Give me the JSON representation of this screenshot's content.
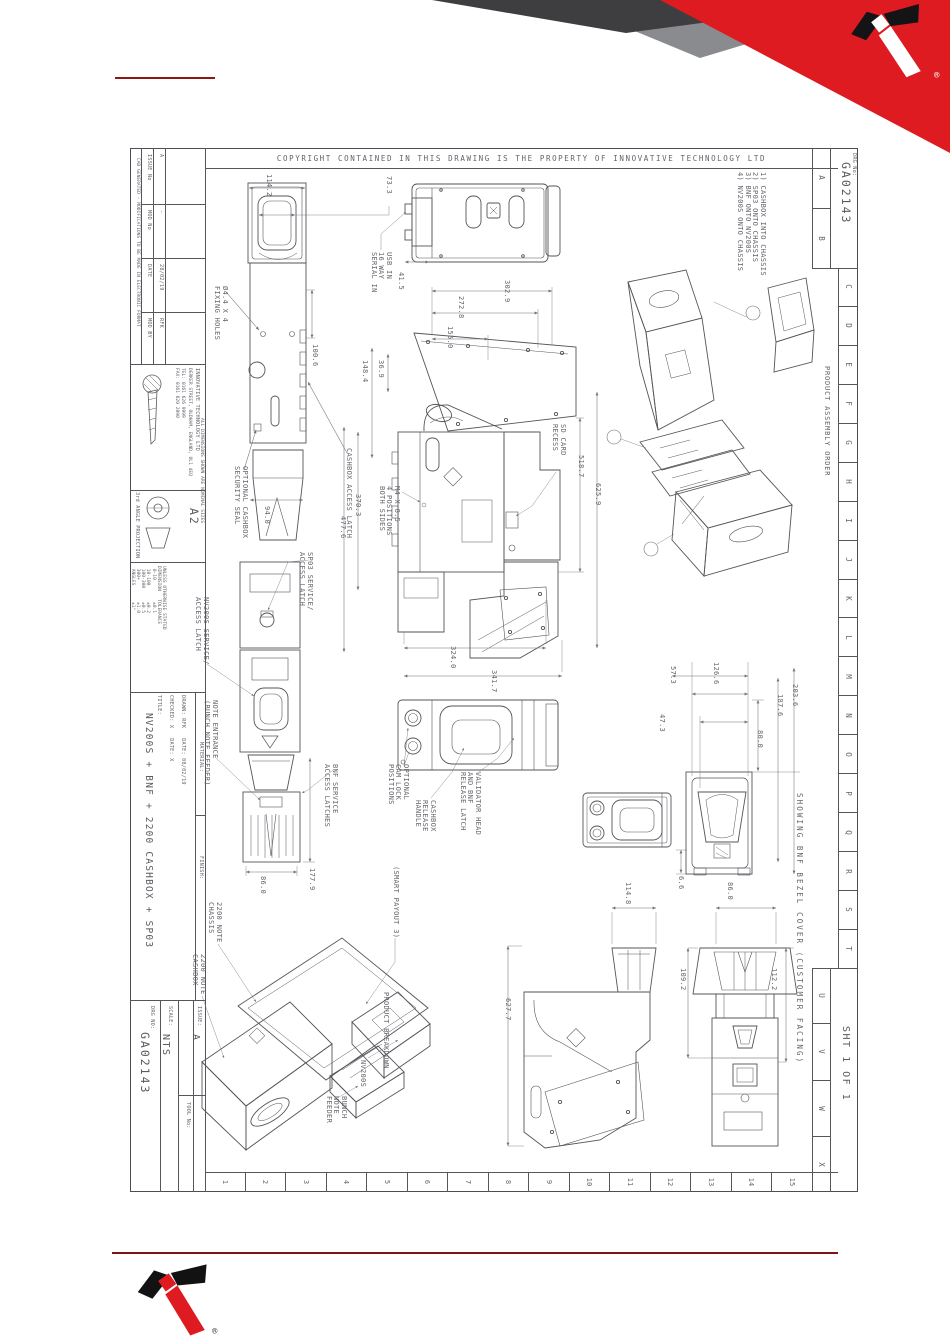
{
  "colors": {
    "accent_red": "#dd1b21",
    "dark_red_rule": "#7a1416",
    "corner_dark": "#3e3e41",
    "corner_mid": "#8a8b8e",
    "line_gray": "#55555a",
    "text_gray": "#64646b"
  },
  "header": {
    "copyright": "COPYRIGHT CONTAINED IN THIS DRAWING IS THE PROPERTY OF INNOVATIVE TECHNOLOGY LTD"
  },
  "drg_box": {
    "label": "DRG No:",
    "number": "GA02143"
  },
  "sheet_box": {
    "text": "SHT 1 OF 1"
  },
  "grid": {
    "letters_top": [
      "A",
      "B"
    ],
    "letters_side": [
      "C",
      "D",
      "E",
      "F",
      "G",
      "H",
      "I",
      "J",
      "K",
      "L",
      "M",
      "N",
      "O",
      "P",
      "Q",
      "R",
      "S",
      "T"
    ],
    "letters_bottom": [
      "U",
      "V",
      "W",
      "X"
    ],
    "numbers": [
      "1",
      "2",
      "3",
      "4",
      "5",
      "6",
      "7",
      "8",
      "9",
      "10",
      "11",
      "12",
      "13",
      "14",
      "15"
    ]
  },
  "title_block": {
    "fine_print": "CAD GENERATED - MODIFICATIONS TO BE MADE IN ELECTRONIC FORMAT",
    "issue_table": {
      "headers": [
        "ISSUE No",
        "MOD No",
        "DATE",
        "MOD BY"
      ],
      "row": [
        "A",
        "-",
        "28/02/19",
        "RFK"
      ]
    },
    "company": {
      "name": "INNOVATIVE TECHNOLOGY LTD",
      "address": "DERKER STREET, OLDHAM, ENGLAND, OL1 4EQ",
      "tel": "TEL: 0161 626 9999",
      "fax": "FAX: 0161 620 2090"
    },
    "projection": "3rd ANGLE PROJECTION",
    "sheet_size": "A2",
    "dims_note": "ALL DIMENSIONS SHOWN ARE NOMINAL SIZES",
    "tol_table": "UNLESS OTHERWISE STATED\nDIMENSION   TOLERANCE\n 0-10        ±0.1\n 10-100      ±0.2\n 100-300     ±0.5\n 300+        ±1.0\n ANGLES      ±1°",
    "checked_line": "CHECKED: X   DATE: X",
    "drawn_line": "DRAWN: RFK   DATE: 08/02/19",
    "title_label": "TITLE:",
    "title": "NV200S + BNF + 2200 CASHBOX + SP03",
    "material_label": "MATERIAL:",
    "finish_label": "FINISH:",
    "scale_label": "SCALE:",
    "scale": "NTS",
    "drg_no_label": "DRG NO:",
    "drg_no": "GA02143",
    "tool_label": "TOOL No:",
    "issue_label": "ISSUE:",
    "issue": "A"
  },
  "assembly": {
    "heading": "PRODUCT ASSEMBLY ORDER",
    "notes": "1) CASHBOX INTO CHASSIS\n2) SP03 ONTO CHASSIS\n3) BNF ONTO NV200S\n4) NV200S ONTO CHASSIS"
  },
  "ann": {
    "d114_2": "114.2",
    "d73_3": "73.3",
    "fixing_holes": "Ø4.4 X 4\nFIXING HOLES",
    "d100_6": "100.6",
    "cashbox_access_latch": "CASHBOX ACCESS LATCH",
    "optional_seal": "OPTIONAL CASHBOX\nSECURITY SEAL",
    "d94_0": "94.0",
    "usb": "USB IN\n16 WAY\nSERIAL IN",
    "d41_5": "41.5",
    "d302_9": "302.9",
    "d272_8": "272.8",
    "d155_0": "155.0",
    "d36_9": "36.9",
    "d148_4": "148.4",
    "d370_3": "370.3",
    "d477_6": "477.6",
    "m4_positions": "M4 X 8.5\n4 POSITIONS\nBOTH SIDES",
    "sd_card": "SD CARD\nRECESS",
    "d518_7": "518.7",
    "d625_9": "625.9",
    "d324_0": "324.0",
    "d341_7": "341.7",
    "sp03_latch": "SP03 SERVICE/\nACCESS LATCH",
    "nv200s_latch": "NV200S SERVICE/\nACCESS LATCH",
    "note_entrance": "NOTE ENTRANCE\n(BUNCH NOTE FEEDER)",
    "bnf_latches": "BNF SERVICE\nACCESS LATCHES",
    "d86_0": "86.0",
    "d177_9": "177.9",
    "cam_lock": "OPTIONAL\nCAM LOCK\nPOSITIONS",
    "cashbox_release": "CASHBOX\nRELEASE\nHANDLE",
    "validator_head": "VALIDATOR HEAD\nAND BNF\nRELEASE LATCH",
    "smart_payout": "(SMART PAYOUT 3)",
    "d57_3": "57.3",
    "d126_6": "126.6",
    "d47_3": "47.3",
    "d80_0": "80.0",
    "d187_6": "187.6",
    "d203_6": "203.6",
    "d6_6": "6.6",
    "showing_bnf": "SHOWING BNF BEZEL COVER (CUSTOMER FACING)",
    "d627_7": "627.7",
    "d114_8": "114.8",
    "d86_0b": "86.0",
    "d109_2": "109.2",
    "d112_2": "112.2",
    "chassis_label": "2200 NOTE\nCHASSIS",
    "cashbox_label": "2200 NOTE\nCASHBOX",
    "nv200s_label": "NV200S",
    "bnf_label": "BUNCH\nNOTE\nFEEDER",
    "product_breakdown": "PRODUCT BREAKDOWN"
  }
}
